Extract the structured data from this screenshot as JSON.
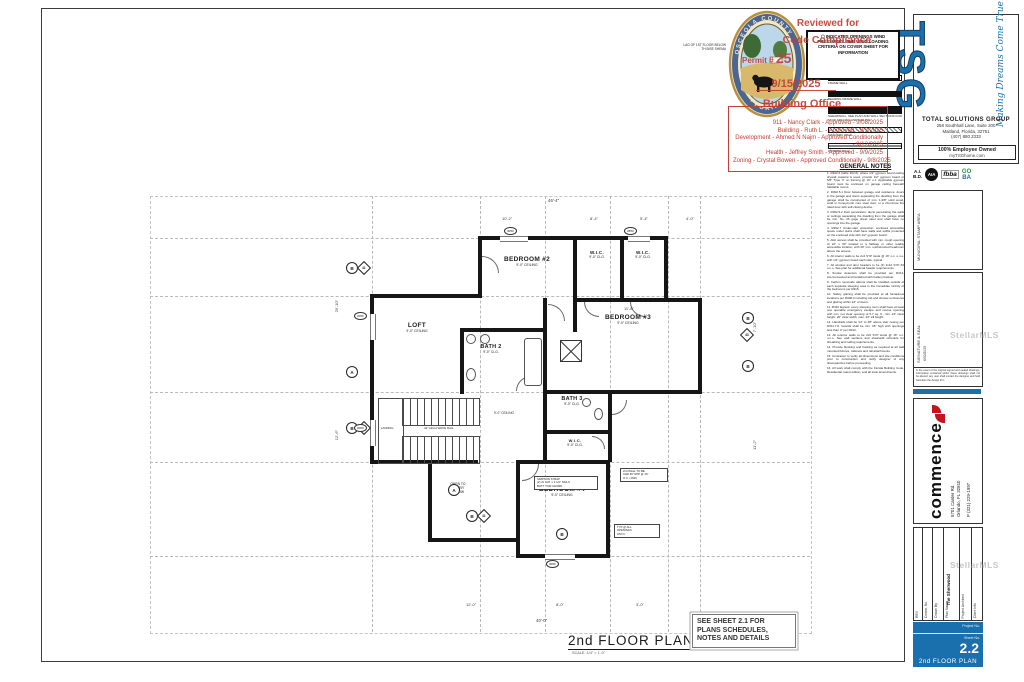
{
  "seal": {
    "top": "OSCEOLA COUNTY",
    "bottom": "FLORIDA"
  },
  "stamp": {
    "line1": "Reviewed for",
    "line2": "Code Compliance",
    "permit_label": "Permit #",
    "permit_no": "25",
    "date": "9/15/2025",
    "office": "Building Office",
    "approvals": [
      "911 - Nancy Clark - Approved - 9/08/2025",
      "Building - Ruth L. - Approved - 9/3/2025",
      "Development - Ahmed N Najm - Approved Conditionally - 9/12/2025",
      "Health - Jeffrey Smith - Approved - 9/9/2025",
      "Zoning - Crystal Bowen - Approved Conditionally - 9/8/2025"
    ]
  },
  "wind": {
    "icon": "⬡",
    "text": "INDICATES OPENINGS WIND PRESSURES. SEE WIND LOADING CRITERIA ON COVER SHEET FOR INFORMATION"
  },
  "legend": {
    "title": "LEGEND",
    "items": [
      {
        "label": "FRAME WALL"
      },
      {
        "label": "BEARING FRAME WALL"
      },
      {
        "label": "SHEARWALL, SEE PLAN AND WALL SECTIONS FOR STUD SPACING AND NAILING"
      },
      {
        "label": "MASONRY WALL"
      },
      {
        "label": "WINDOW WALL"
      }
    ]
  },
  "gn": {
    "title": "GENERAL NOTES",
    "notes": [
      "1. R302.6 (table 302.6): where 1/2\" gypsum board ceiling drywall material is used, provide 1/2\" gypsum board or 5/8\" Type 'X' on framing @ 16\" o.c. Applicable gypsum board must be enclosed on garage ceiling beneath habitable rooms.",
      "2. R302.5.1 Door between garage and residence: doors in the garage and doors separating the dwelling from the garage shall be constructed of min. 1-3/8\" solid wood, solid or honeycomb core steel door, or a 20-minute fire rated door with self-closing device.",
      "3. R302.5.2 Duct penetration: ducts penetrating the walls or ceilings separating the dwelling from the garage shall be min. No. 26 gage sheet steel and shall have no openings into the garage.",
      "4. R302.7 Under-stair protection: enclosed accessible space under stairs shall have walls and soffits protected on the enclosed side with 1/2\" gypsum board.",
      "5. Attic access shall be provided with min. rough opening of 22\" x 30\" located in a hallway or other readily accessible location, with 30\" min. unobstructed headroom above the access.",
      "6. All interior walls to be 2x4 SYP studs @ 16\" o.c. u.n.o. with 1/2\" gypsum board each side, typical.",
      "7. All window and door headers to be (2) 2x10 SYP #2 u.n.o. See plan for additional header requirements.",
      "8. Smoke detectors shall be provided per R314, interconnected and hardwired with battery backup.",
      "9. Carbon monoxide alarms shall be installed outside of each separate sleeping area in the immediate vicinity of the bedrooms per R315.",
      "10. Safety glazing shall be provided at all hazardous locations per R308.4 including tub and shower enclosures and glazing within 24\" of doors.",
      "11. R310 Egress: every sleeping room shall have at least one operable emergency escape and rescue opening with min. net clear opening of 5.7 sq. ft., min. 24\" clear height, 20\" clear width, max. 44\" sill height.",
      "12. Handrails shall be 34\" to 38\" above stair nosing per R311.7.8. Guards shall be min. 36\" high with openings less than 4\" per R312.",
      "13. All exterior walls to be 2x6 SYP studs @ 16\" o.c. u.n.o. See wall sections and shearwall schedule for sheathing and nailing requirements.",
      "14. Provide blocking and backing as required at all wall mounted fixtures, cabinets and rail attachments.",
      "15. Contractor to verify all dimensions and site conditions prior to construction and notify designer of any discrepancies before proceeding.",
      "16. All work shall comply with the Florida Building Code, Residential, latest edition, and all local amendments."
    ]
  },
  "plan": {
    "title": "2nd FLOOR PLAN",
    "scale": "SCALE: 1/4\" = 1'-0\"",
    "see_sheet": [
      "SEE SHEET 2.1 FOR",
      "PLANS SCHEDULES,",
      "NOTES AND DETAILS"
    ],
    "below1": "LAG OF 1ST FLOOR BELOW",
    "below2": "TH B/SE SHEMA",
    "rooms": [
      {
        "name": "BEDROOM #2",
        "ceil": "9'-0\" CEILING"
      },
      {
        "name": "W.I.C.",
        "ceil": "9'-0\" CLG."
      },
      {
        "name": "W.I.C.",
        "ceil": "9'-0\" CLG."
      },
      {
        "name": "BEDROOM #3",
        "ceil": "9'-0\" CEILING"
      },
      {
        "name": "LOFT",
        "ceil": "9'-0\" CEILING"
      },
      {
        "name": "BATH 2",
        "ceil": "9'-0\" CLG."
      },
      {
        "name": "BATH 3",
        "ceil": "9'-0\" CLG."
      },
      {
        "name": "W.I.C.",
        "ceil": "9'-0\" CLG."
      },
      {
        "name": "BEDROOM #4",
        "ceil": "9'-0\" CEILING"
      }
    ],
    "open_lines": [
      "OPEN TO",
      "FOYER",
      "BELOW"
    ],
    "landing": "LANDING",
    "rail": "42\" HIGH WAVE RAIL",
    "ceiling_note": "9'-0\" CEILING",
    "dims": [
      "46'-4\"",
      "10'-2\"",
      "8'-4\"",
      "5'-4\"",
      "4'-0\"",
      "29'-10\"",
      "12'-6\"",
      "12'-0\"",
      "8'-0\"",
      "40'-0\"",
      "7'-10\"",
      "11'-2\"",
      "3'-0\"",
      "11'-8\""
    ],
    "tags": [
      "3050",
      "2850",
      "2050",
      "2050",
      "3050"
    ],
    "markers": [
      "B",
      "A",
      "B",
      "A",
      "B",
      "B",
      "B",
      "B"
    ],
    "diamonds": [
      "41",
      "42",
      "41",
      "43"
    ],
    "strap": [
      "SIMPSON STRAP",
      "(2) 2x NAT. x 2 1/2\" NAILS",
      "BOTT TOM CHORD"
    ],
    "wallnote": [
      "2x4 WALL TO BE",
      "CHD BY NPP @ 16\"",
      "O.C. (JND)"
    ],
    "typnote": [
      "TYP @ ALL",
      "OPENINGS",
      "2/M O."
    ]
  },
  "rail": {
    "tsg": {
      "name": "TSG",
      "tagline": "Making Dreams Come True",
      "company": "TOTAL SOLUTIONS GROUP",
      "addr1": "258 Southhall Lane, Suite 200",
      "addr2": "Maitland, Florida, 32751",
      "phone": "(407) 880 2333",
      "owned": "100% Employee Owned",
      "site": "myTSGhome.com"
    },
    "badges": {
      "aibd1": "A.I.",
      "aibd2": "B.D.",
      "aia": "AIA",
      "fbba": "fbba",
      "go": "GO",
      "ba": "BA"
    },
    "municipal": "MUNICIPAL STAMP AREA",
    "sig_label": "SIGNATURE & SEAL",
    "sig_date": "6/30/2025",
    "sig_disclaimer": "In the event of the original signed and sealed drawings, information contained within these drawings shall not be altered; any user shall contact the designer and hold harmless the design firm.",
    "commence": {
      "name": "commence",
      "addr": "5701 Carder Rd.",
      "city": "Orlando, FL 32810",
      "phone": "P (321) 229-1997"
    },
    "fields": [
      {
        "label": "REV"
      },
      {
        "label": "Comm. No."
      },
      {
        "label": "Drawn By"
      },
      {
        "label": "Plan Name",
        "value": "The Sherwood"
      },
      {
        "label": "Project Architect"
      },
      {
        "label": "Client Info"
      }
    ],
    "sheet": {
      "project_label": "Project No.",
      "sheet_label": "Sheet No.",
      "number": "2.2",
      "title": "2nd  FLOOR PLAN"
    }
  },
  "watermark": "StellarMLS"
}
